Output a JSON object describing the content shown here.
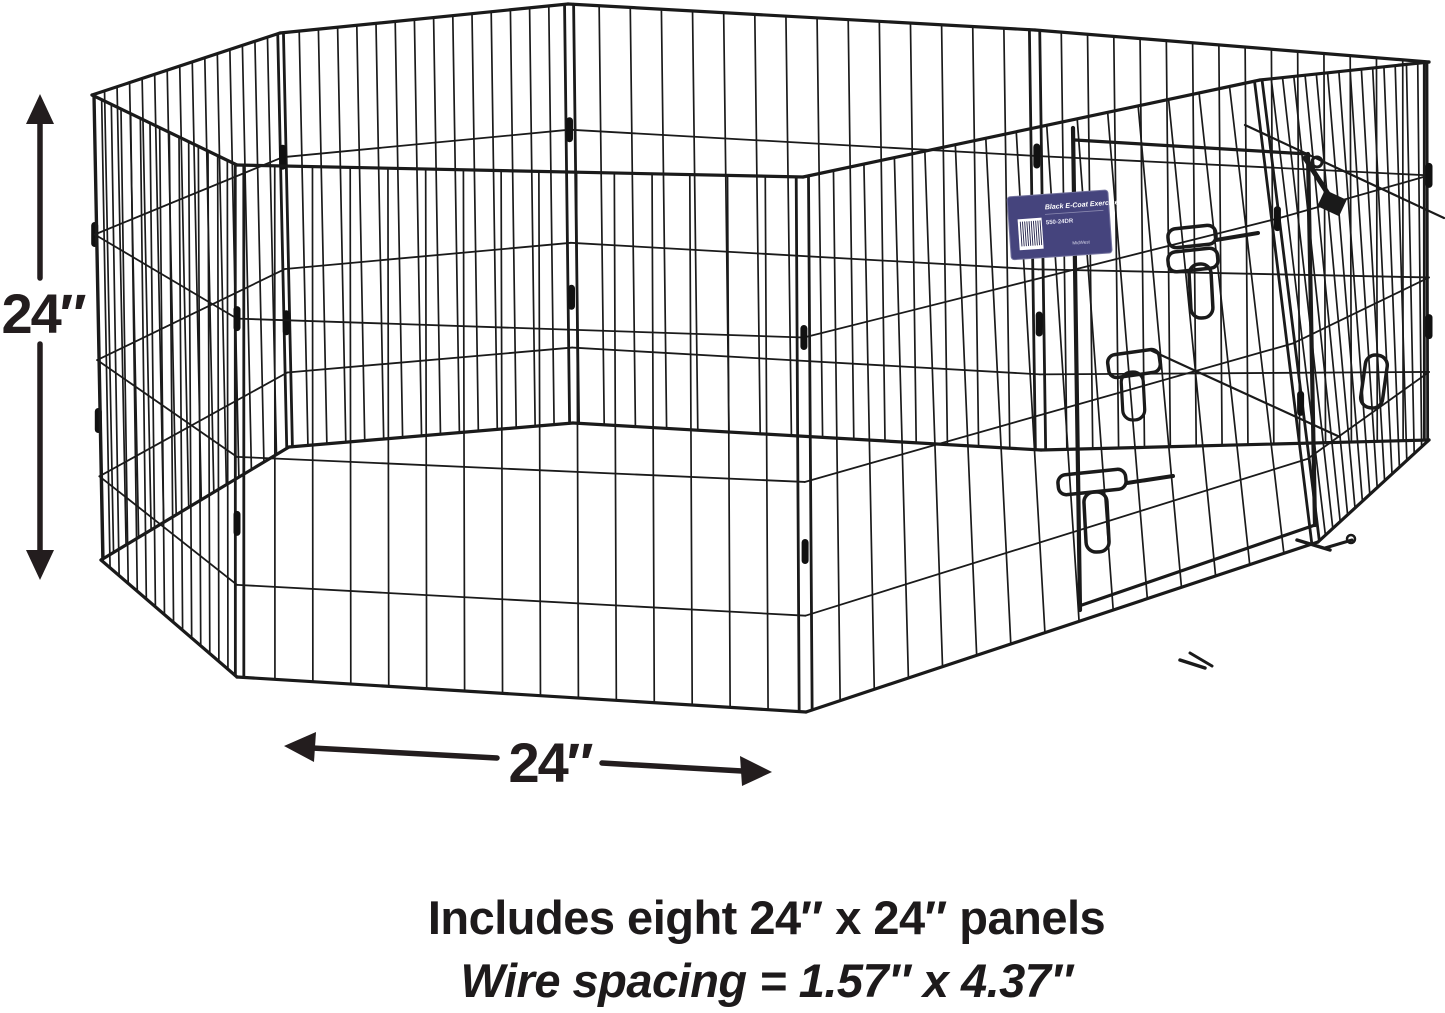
{
  "meta": {
    "background_color": "#ffffff",
    "ink_color": "#231d1e",
    "wire_color": "#1a1a1a"
  },
  "dimensions": {
    "height_label": "24″",
    "width_label": "24″"
  },
  "caption": {
    "line1": "Includes eight 24″ x 24″ panels",
    "line2": "Wire spacing = 1.57″ x 4.37″"
  },
  "product_tag": {
    "title": "Black E-Coat Exercise Pen",
    "model": "550-24DR",
    "brand": "MidWest",
    "background_color": "#45447d",
    "border_color": "#74739e",
    "barcode": "barcode"
  },
  "pen": {
    "panel_count": 8,
    "vertical_wires_per_panel": 14,
    "horizontal_wire_fractions": [
      0.3,
      0.57,
      0.82
    ]
  }
}
